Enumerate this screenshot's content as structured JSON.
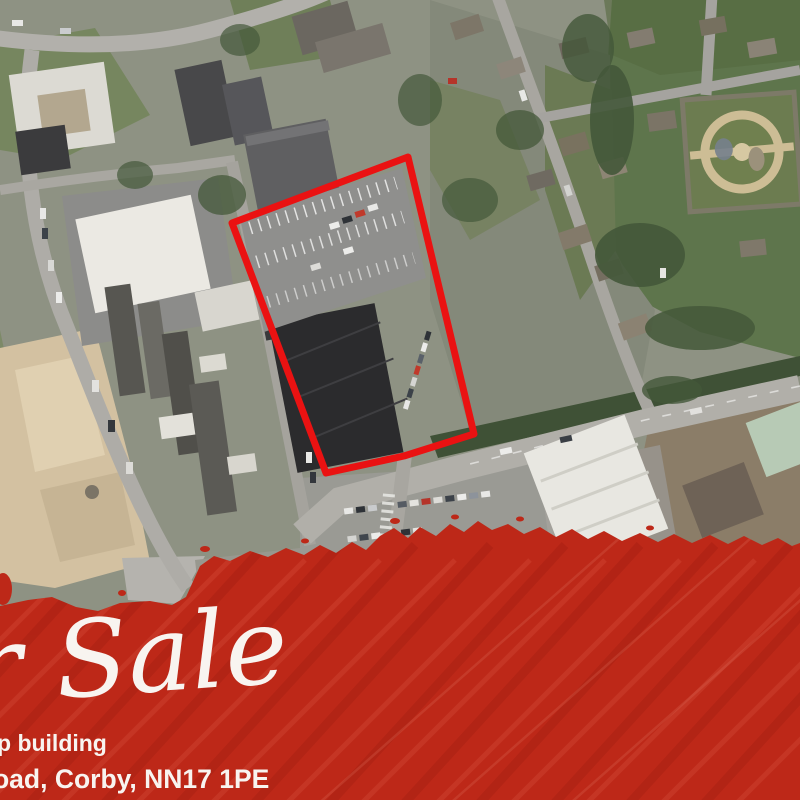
{
  "flyer": {
    "script_text": "For Sale",
    "description_fragment": "p building",
    "address_fragment": "oad, Corby, NN17 1PE",
    "banner_color": "#bd2818",
    "banner_streak_light": "#d85340",
    "banner_streak_dark": "#961c10",
    "boundary_color": "#ea1212",
    "text_color": "#f8f4f0"
  },
  "site_outline": {
    "points": "232,223 408,157 474,434 404,456 326,473"
  }
}
